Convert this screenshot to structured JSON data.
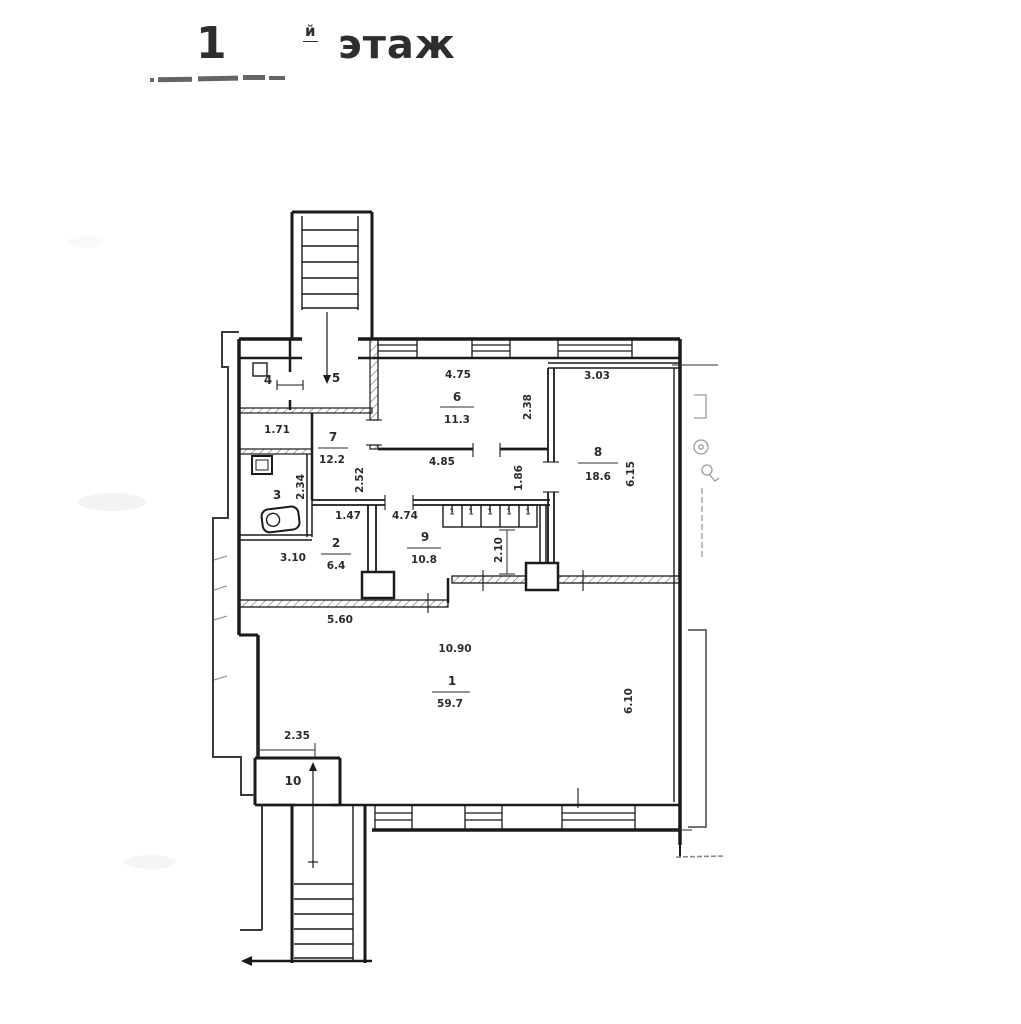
{
  "title": {
    "number": "1",
    "suffix": "й",
    "word": "этаж"
  },
  "rooms": {
    "1": {
      "number": "1",
      "area": "59.7"
    },
    "2": {
      "number": "2",
      "area": "6.4"
    },
    "3": {
      "number": "3"
    },
    "4": {
      "number": "4"
    },
    "5": {
      "number": "5"
    },
    "6": {
      "number": "6",
      "area": "11.3"
    },
    "7": {
      "number": "7",
      "area": "12.2"
    },
    "8": {
      "number": "8",
      "area": "18.6"
    },
    "9": {
      "number": "9",
      "area": "10.8"
    },
    "10": {
      "number": "10"
    }
  },
  "dimensions": {
    "room6_width": "4.75",
    "room6_depth": "2.38",
    "room8_width": "3.03",
    "room8_depth": "6.15",
    "corridor_width": "4.85",
    "corridor_depth": "2.52",
    "corridor_right_depth": "1.86",
    "niche_width": "1.71",
    "wc_depth": "2.34",
    "passage_width": "1.47",
    "room9_width": "4.74",
    "room9_opening_depth": "2.10",
    "room2_width": "3.10",
    "hall_upper_width": "5.60",
    "hall_width": "10.90",
    "hall_depth": "6.10",
    "entrance_width": "2.35"
  },
  "closets": {
    "cells": [
      "1",
      "1",
      "1",
      "1",
      "1"
    ]
  },
  "colors": {
    "ink": "#1a1a1a",
    "paper": "#ffffff"
  }
}
